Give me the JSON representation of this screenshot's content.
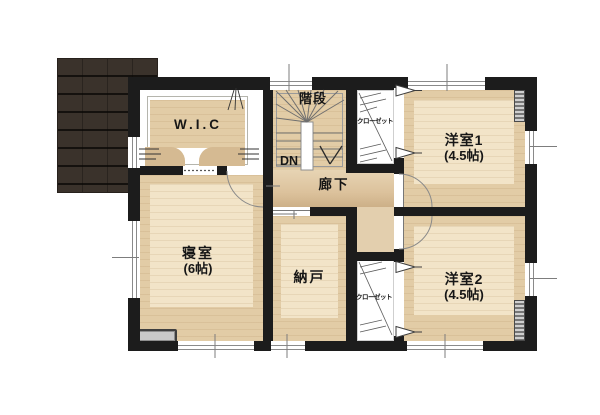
{
  "rooms": {
    "wic": {
      "label": "W.I.C"
    },
    "stairs": {
      "label": "階段",
      "down": "DN"
    },
    "hallway": {
      "label": "廊下"
    },
    "closet_upper": {
      "label": "クローゼット"
    },
    "closet_lower": {
      "label": "クローゼット"
    },
    "western1": {
      "label": "洋室1",
      "size": "(4.5帖)"
    },
    "western2": {
      "label": "洋室2",
      "size": "(4.5帖)"
    },
    "bedroom": {
      "label": "寝室",
      "size": "(6帖)"
    },
    "storage": {
      "label": "納戸"
    }
  },
  "colors": {
    "wall": "#1c1c1c",
    "room_floor": "#e2cca6",
    "room_floor_light": "#f2e4c8",
    "hall_floor": "#d8bd97",
    "closet_floor": "#ffffff",
    "roof": "#3a322b",
    "bench_gray": "#c9c9c9",
    "background": "#ffffff"
  }
}
